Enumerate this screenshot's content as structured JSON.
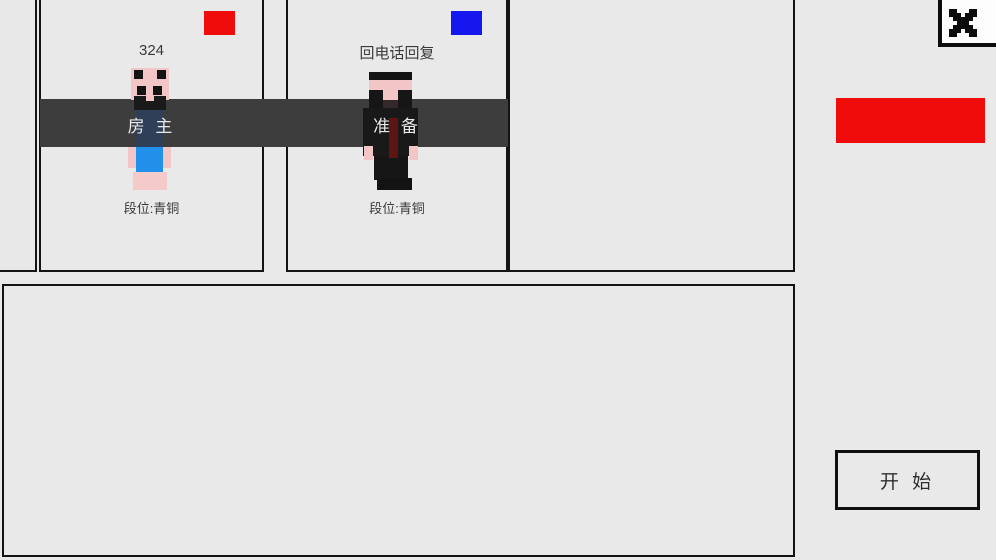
{
  "lobby": {
    "players": [
      {
        "name": "324",
        "status_label": "房 主",
        "rank": "段位:青铜",
        "team_color": "#f10c0c"
      },
      {
        "name": "回电话回复",
        "status_label": "准 备",
        "rank": "段位:青铜",
        "team_color": "#1616ee"
      }
    ]
  },
  "actions": {
    "start_label": "开 始"
  },
  "icons": {
    "close": "pixel-x-icon"
  },
  "colors": {
    "band": "#3d3d3d",
    "accent_red": "#f10c0c",
    "accent_blue": "#1616ee",
    "skin_pink": "#f2c6c6",
    "shirt_blue": "#2090ea",
    "suit_black": "#181818",
    "tie_red": "#5c1414"
  }
}
